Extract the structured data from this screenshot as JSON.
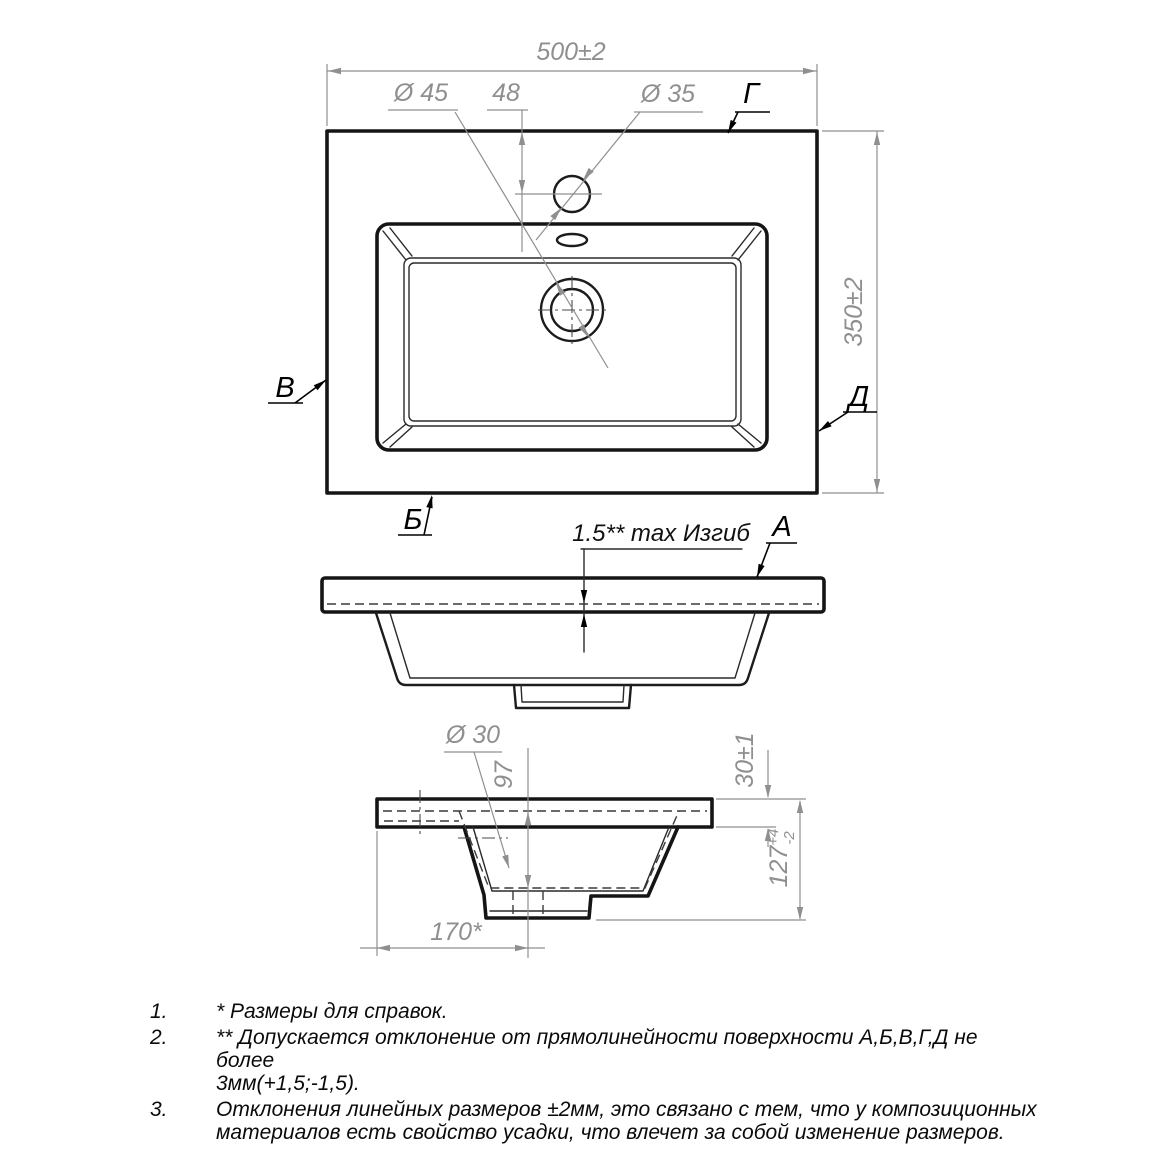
{
  "plan": {
    "width_dim": "500±2",
    "height_dim": "350±2",
    "faucet_offset_dim": "48",
    "recess_dia": "Ø 45",
    "faucet_dia": "Ø 35",
    "surface_top": "Г",
    "surface_left": "В",
    "surface_right": "Д",
    "surface_bottom": "Б"
  },
  "front": {
    "bend_note": "1.5** max Изгиб",
    "surface_label": "А"
  },
  "section": {
    "drain_dia": "Ø 30",
    "depth_dim": "97",
    "thickness_dim": "30±1",
    "height_value": "127",
    "height_tol_plus": "+4",
    "height_tol_minus": "-2",
    "drain_offset_dim": "170*"
  },
  "notes": {
    "items": [
      {
        "num": "1.",
        "line1": "*  Размеры для справок."
      },
      {
        "num": "2.",
        "line1": "**  Допускается отклонение от прямолинейности поверхности А,Б,В,Г,Д не более",
        "line2": "3мм(+1,5;-1,5)."
      },
      {
        "num": "3.",
        "line1": "Отклонения линейных размеров ±2мм, это связано с тем, что у композиционных",
        "line2": "материалов есть свойство усадки, что влечет за собой изменение размеров."
      }
    ]
  }
}
